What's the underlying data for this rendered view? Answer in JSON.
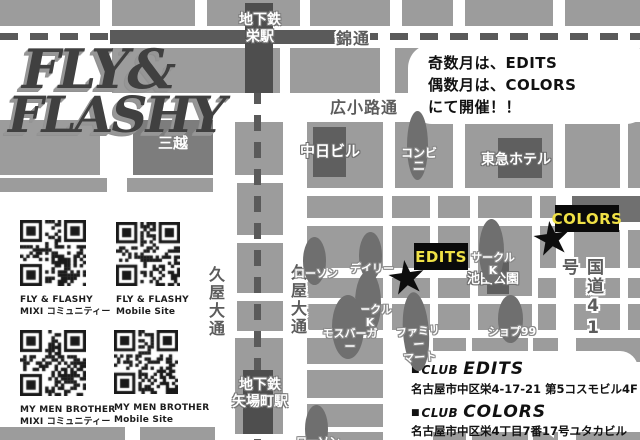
{
  "logo": {
    "line1": "FLY&",
    "line2": "FLASHY"
  },
  "schedule_note": {
    "line1": "奇数月は、EDITS",
    "line2": "偶数月は、COLORS",
    "line3": "にて開催！！"
  },
  "map": {
    "marker_glyph": "★",
    "stations": {
      "sakae": "地下鉄\n栄駅",
      "yabacho": "地下鉄\n矢場町駅"
    },
    "roads": {
      "nishiki": "錦通",
      "hirokoji": "広小路通",
      "hisaya_left": "久屋大通",
      "hisaya_right": "久屋大通",
      "route41": "国道41号"
    },
    "buildings": {
      "mitsukoshi": "三越",
      "chunichi": "中日ビル",
      "tokyu": "東急ホテル",
      "ikeda_park": "池田公園"
    },
    "stores": {
      "conbini": "コンビニ",
      "lawson_top": "ローソン",
      "daily": "デイリー",
      "circlek_top": "サークルK",
      "circlek_mid": "サークルK",
      "mos_burger": "モスバーガー",
      "family_mart": "ファミリー\nマート",
      "shop99": "ショプ99",
      "lawson_bottom": "ローソン"
    },
    "venues": {
      "edits": "EDITS",
      "colors": "COLORS"
    }
  },
  "qr_items": [
    {
      "title": "FLY & FLASHY",
      "subtitle": "MIXI コミュニティー"
    },
    {
      "title": "FLY & FLASHY",
      "subtitle": "Mobile Site"
    },
    {
      "title": "MY MEN BROTHER",
      "subtitle": "MIXI コミュニティー"
    },
    {
      "title": "MY MEN BROTHER",
      "subtitle": "Mobile Site"
    }
  ],
  "clubs": [
    {
      "bullet": "■",
      "prefix": "CLUB",
      "name": "EDITS",
      "address": "名古屋市中区栄4-17-21 第5コスモビル4F"
    },
    {
      "bullet": "■",
      "prefix": "CLUB",
      "name": "COLORS",
      "address": "名古屋市中区栄4丁目7番17号ユタカビル3F"
    }
  ],
  "colors": {
    "accent_yellow": "#f0e146",
    "block_gray": "#9c9c9c",
    "dark_building": "#707070",
    "station_dark": "#4e4e4e",
    "marker_black": "#0d0d0d"
  }
}
